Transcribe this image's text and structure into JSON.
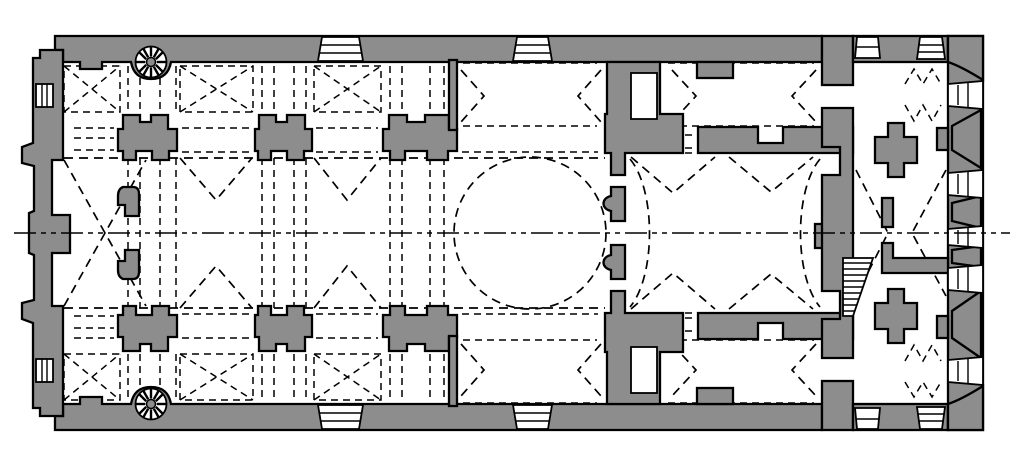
{
  "meta": {
    "type": "architectural-floor-plan",
    "subject": "longitudinal basilica church plan with domed bay",
    "contains_text": false
  },
  "canvas": {
    "width": 1024,
    "height": 466
  },
  "colors": {
    "background": "#ffffff",
    "wall_fill": "#8d8d8d",
    "outline": "#000000",
    "open_space": "#ffffff"
  },
  "linework": {
    "wall_outline_px": 2.3,
    "vault_dash_pattern": "9 6",
    "centerline_pattern": "22 5 5 5 5 5",
    "centerline_y": 233
  },
  "features": {
    "dome": {
      "center_x": 530,
      "center_y": 233,
      "radius": 76,
      "style": "dashed-circle"
    },
    "spiral_staircases": [
      {
        "center_x": 151,
        "center_y": 62
      },
      {
        "center_x": 151,
        "center_y": 404
      }
    ],
    "nave_pier_pairs": 4,
    "aisle_groin_vault_bays": 6,
    "portals_top": 4,
    "portals_bottom": 4,
    "east_facade_openings": 5,
    "stair_flight": {
      "x": 843,
      "y": 258,
      "treads": 9
    },
    "west_wall": "stepped apsidal wall with twin niches and mullioned slits",
    "narthex": "east corridor with cross piers, chevron vault lines and zigzag stair marks"
  }
}
